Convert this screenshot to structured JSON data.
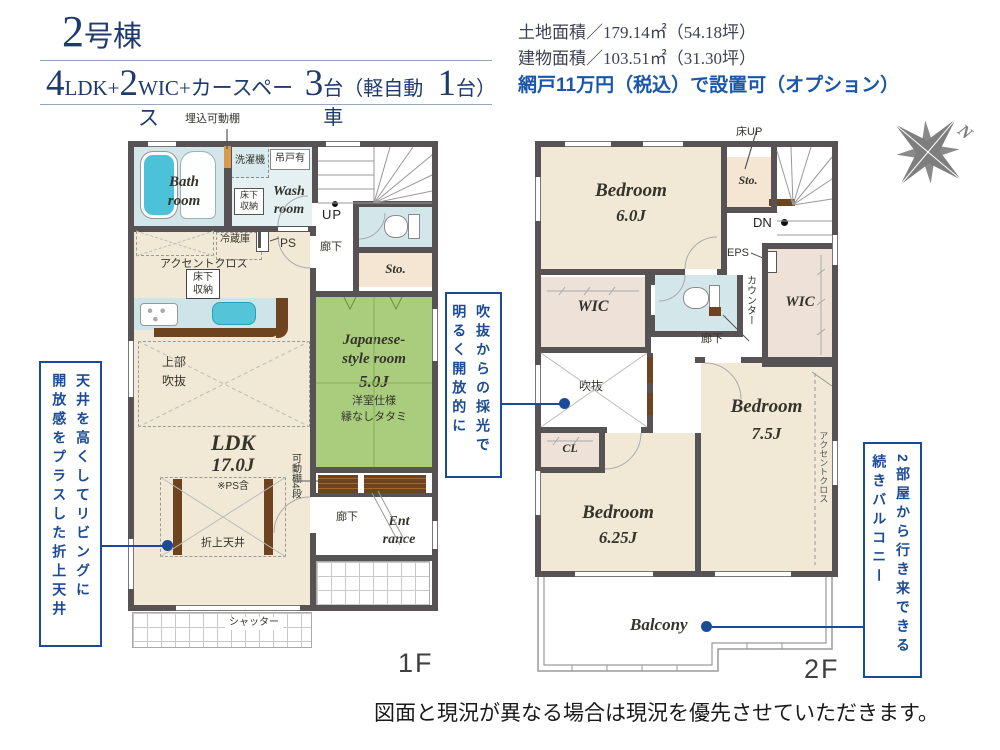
{
  "header": {
    "building_num": "2",
    "building_suffix": "号棟",
    "n1": "4",
    "t1": "LDK+",
    "n2": "2",
    "t2": "WIC+カースペース",
    "n3": "3",
    "t3": "台（軽自動車",
    "n4": "1",
    "t4": "台）"
  },
  "site": {
    "land_area": "土地面積／179.14㎡（54.18坪）",
    "building_area": "建物面積／103.51㎡（31.30坪）",
    "option_note": "網戸11万円（税込）で設置可（オプション）"
  },
  "compass": {
    "north": "N"
  },
  "f1": {
    "embedded_shelf": "埋込可動棚",
    "washer": "洗濯機",
    "hanging_cupboard": "吊戸有",
    "underfloor_wash": "床下\n収納",
    "bath": "Bath\nroom",
    "wash": "Wash\nroom",
    "up": "UP",
    "hall_upper": "廊下",
    "sto": "Sto.",
    "ps": "PS",
    "fridge": "冷蔵庫",
    "accent_cloth": "アクセントクロス",
    "underfloor_ldk": "床下\n収納",
    "upper_void": "上部\n吹抜",
    "ldk": "LDK",
    "ldk_size": "17.0J",
    "ps_note": "※PS含",
    "coffered": "折上天井",
    "jp_room": "Japanese-\nstyle room",
    "jp_size": "5.0J",
    "jp_note1": "洋室仕様",
    "jp_note2": "縁なしタタミ",
    "shelf4": "可動棚4段",
    "hall_lower": "廊下",
    "entrance": "Ent\nrance",
    "shutter": "シャッター",
    "floor": "1F"
  },
  "f2": {
    "floor_up": "床UP",
    "bed6": "Bedroom",
    "bed6_size": "6.0J",
    "sto": "Sto.",
    "dn": "DN",
    "eps": "EPS",
    "counter": "カウンター",
    "wic_left": "WIC",
    "wic_right": "WIC",
    "hall": "廊下",
    "void": "吹抜",
    "cl": "CL",
    "bed625": "Bedroom",
    "bed625_size": "6.25J",
    "bed75": "Bedroom",
    "bed75_size": "7.5J",
    "accent_cloth": "アクセントクロス",
    "balcony": "Balcony",
    "floor": "2F"
  },
  "annotations": {
    "left": "天井を高くしてリビングに\n開放感をプラスした折上天井",
    "middle": "吹抜からの採光で\n明るく開放的に",
    "right": "2部屋から行き来できる\n続きバルコニー"
  },
  "footer": "図面と現況が異なる場合は現況を優先させていただきます。",
  "colors": {
    "navy": "#1e3a6e",
    "blue": "#1b4b96",
    "boldblue": "#1a57ac",
    "wall": "#575254",
    "beige": "#f1e9d6",
    "lblue": "#d3e6ea",
    "green": "#a9cc7d",
    "wic": "#ede1d8",
    "sto": "#f5e5d3",
    "brown": "#6d441f",
    "cyan": "#4cc2d9"
  }
}
